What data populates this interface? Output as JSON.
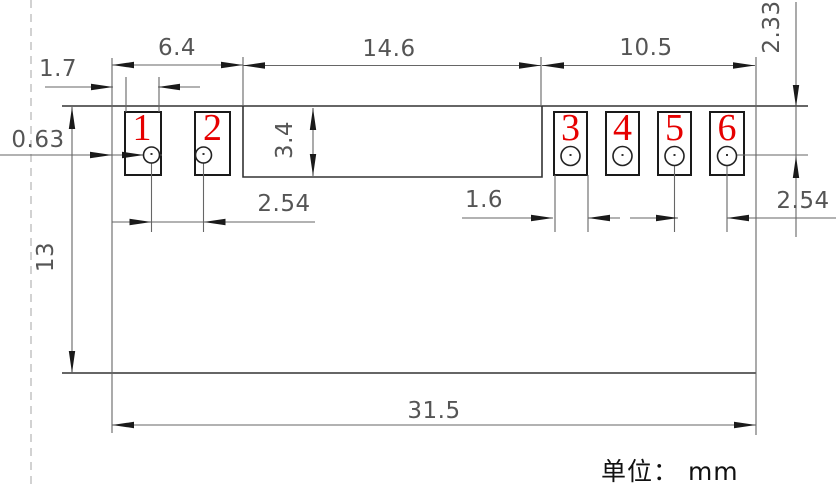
{
  "canvas": {
    "width": 836,
    "height": 490,
    "background": "#ffffff"
  },
  "colors": {
    "outline": "#333333",
    "thin_line": "#666666",
    "arrowhead": "#1a1a1a",
    "dim_text": "#555555",
    "pad_number_red": "#e60000",
    "dashed_datum_line": "#b5b5b5",
    "unit_text": "#111111"
  },
  "unit_note": "单位： mm",
  "pads": [
    {
      "number": "1"
    },
    {
      "number": "2"
    },
    {
      "number": "3"
    },
    {
      "number": "4"
    },
    {
      "number": "5"
    },
    {
      "number": "6"
    }
  ],
  "dimensions": {
    "top_left_width": "6.4",
    "top_middle_width": "14.6",
    "top_right_width": "10.5",
    "pad1_edge_offset": "1.7",
    "left_edge_offset": "0.63",
    "body_height": "13",
    "middle_notch_height": "3.4",
    "right_hole_top_offset": "2.33",
    "left_hole_pitch": "2.54",
    "pad_width": "1.6",
    "right_hole_pitch": "2.54",
    "total_width": "31.5"
  }
}
